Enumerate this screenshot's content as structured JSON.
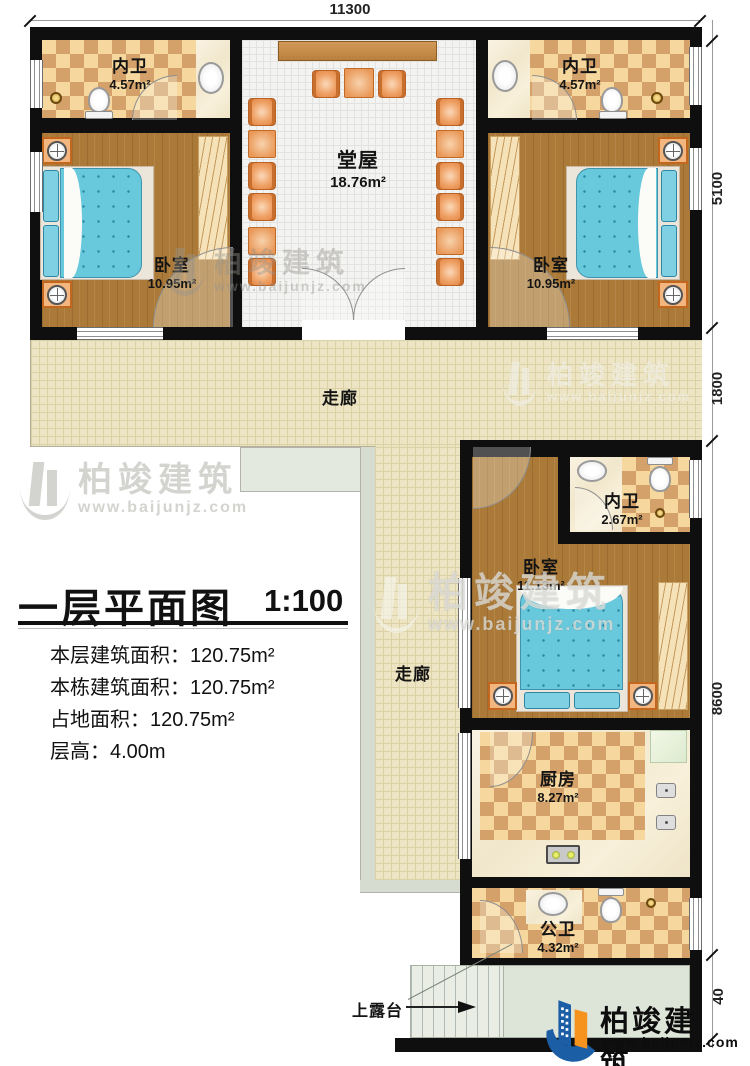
{
  "dimensions": {
    "top": "11300",
    "right": [
      "5100",
      "1800",
      "8600",
      "40"
    ]
  },
  "rooms": {
    "bath_left": {
      "name": "内卫",
      "area": "4.57m²"
    },
    "bath_right": {
      "name": "内卫",
      "area": "4.57m²"
    },
    "hall": {
      "name": "堂屋",
      "area": "18.76m²"
    },
    "bed_left": {
      "name": "卧室",
      "area": "10.95m²"
    },
    "bed_right": {
      "name": "卧室",
      "area": "10.95m²"
    },
    "corridor_front": {
      "name": "走廊"
    },
    "corridor_side": {
      "name": "走廊"
    },
    "bath_inner": {
      "name": "内卫",
      "area": "2.67m²"
    },
    "bed_lower": {
      "name": "卧室",
      "area": "11.13m²"
    },
    "kitchen": {
      "name": "厨房",
      "area": "8.27m²"
    },
    "bath_public": {
      "name": "公卫",
      "area": "4.32m²"
    }
  },
  "annotations": {
    "stairs": "上露台"
  },
  "title_block": {
    "title": "一层平面图",
    "scale": "1:100",
    "rows": [
      {
        "label": "本层建筑面积：",
        "value": "120.75m²"
      },
      {
        "label": "本栋建筑面积：",
        "value": "120.75m²"
      },
      {
        "label": "占地面积：",
        "value": "120.75m²"
      },
      {
        "label": "层高：",
        "value": "4.00m"
      }
    ]
  },
  "branding": {
    "name": "柏竣建筑",
    "website": "www.baijunjz.com"
  },
  "watermark": {
    "name": "柏竣建筑",
    "website": "www.baijunjz.com"
  },
  "colors": {
    "brand_blue": "#1b5ea6",
    "brand_orange": "#f6921e"
  }
}
